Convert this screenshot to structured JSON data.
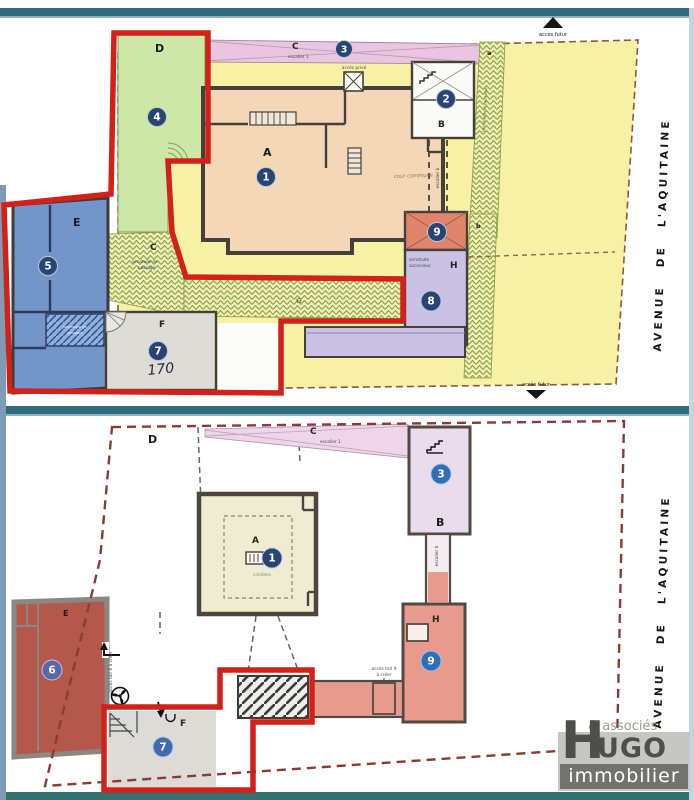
{
  "street": {
    "label": "AVENUE DE L'AQUITAINE"
  },
  "logo": {
    "associes": "& associés",
    "hugo_h": "H",
    "hugo_rest": "UGO",
    "sub": "immobilier"
  },
  "colors": {
    "red_outline": "#d32018",
    "lot_circle_navy": "#274472",
    "lot_circle_blue": "#2e6fb8",
    "parcel_yellow": "#f6f1a4",
    "lot_green": "#cde8a6",
    "lot_blue": "#7495ca",
    "lot_lavender": "#cac2e4",
    "lot_salmon": "#e0846c",
    "lot_brick": "#b4584c",
    "boundary_dash": "#8a3c34",
    "frame_teal": "#2e6b7e"
  },
  "top_plan": {
    "regions": {
      "a": "A",
      "b": "B",
      "c_strip": "C",
      "c_hatch": "C",
      "d": "D",
      "e": "E",
      "f": "F",
      "g": "G",
      "h": "H",
      "zone_a": "a",
      "zone_b": "b"
    },
    "lots": {
      "n1": "1",
      "n2": "2",
      "n3": "3",
      "n4": "4",
      "n5": "5",
      "n7": "7",
      "n8": "8",
      "n9": "9"
    },
    "texts": {
      "escalier_1": "escalier 1",
      "escalier_b": "escalier b",
      "acces_prive": "accès privé",
      "cour_commune": "cour commune",
      "servitude_1": "servitude",
      "servitude_2": "ascenseur",
      "acces_futur": "accès futur",
      "passage_full": "servitude de passage",
      "passage_1": "servitude de",
      "passage_2": "passage",
      "handwritten": "170"
    }
  },
  "bottom_plan": {
    "regions": {
      "a": "A",
      "b": "B",
      "c": "C",
      "d": "D",
      "e": "E",
      "f": "F",
      "h": "H"
    },
    "lots": {
      "n1": "1",
      "n3": "3",
      "n6": "6",
      "n7": "7",
      "n9": "9"
    },
    "texts": {
      "escalier_1": "escalier 1",
      "escalier_b": "escalier b",
      "combles": "combles",
      "acces_toit9_1": "accès toit 9",
      "acces_toit9_2": "à créer",
      "acces_toit6": "accès toit 6 à créer"
    }
  }
}
